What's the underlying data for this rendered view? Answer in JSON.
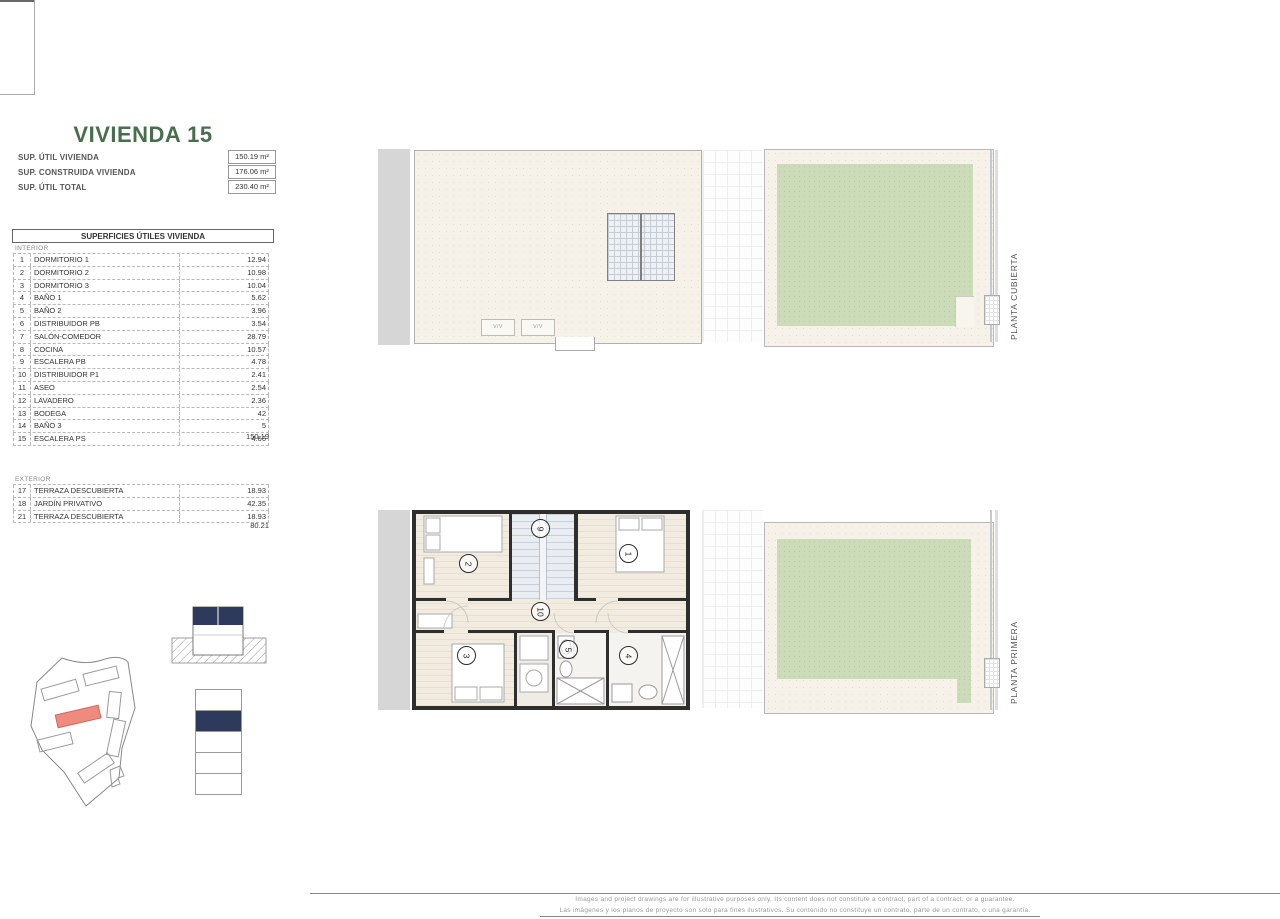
{
  "colors": {
    "accent_green": "#4a6e4d",
    "garden_green": "#cddcb8",
    "site_highlight": "#ee8b7e",
    "level_navy": "#2e3a5c",
    "wall_dark": "#2e2e2e"
  },
  "panel": {
    "title": "VIVIENDA 15",
    "summary": [
      {
        "label": "SUP. ÚTIL VIVIENDA",
        "value": "150.19 m²"
      },
      {
        "label": "SUP. CONSTRUIDA VIVIENDA",
        "value": "176.06 m²"
      },
      {
        "label": "SUP. ÚTIL TOTAL",
        "value": "230.40 m²"
      }
    ],
    "table_header": "SUPERFICIES ÚTILES VIVIENDA",
    "interior_label": "INTERIOR",
    "interior_rows": [
      {
        "n": "1",
        "name": "DORMITORIO 1",
        "value": "12.94"
      },
      {
        "n": "2",
        "name": "DORMITORIO 2",
        "value": "10.98"
      },
      {
        "n": "3",
        "name": "DORMITORIO 3",
        "value": "10.04"
      },
      {
        "n": "4",
        "name": "BAÑO 1",
        "value": "5.62"
      },
      {
        "n": "5",
        "name": "BAÑO 2",
        "value": "3.96"
      },
      {
        "n": "6",
        "name": "DISTRIBUIDOR PB",
        "value": "3.54"
      },
      {
        "n": "7",
        "name": "SALÓN-COMEDOR",
        "value": "28.79"
      },
      {
        "n": "8",
        "name": "COCINA",
        "value": "10.57"
      },
      {
        "n": "9",
        "name": "ESCALERA PB",
        "value": "4.78"
      },
      {
        "n": "10",
        "name": "DISTRIBUIDOR P1",
        "value": "2.41"
      },
      {
        "n": "11",
        "name": "ASEO",
        "value": "2.54"
      },
      {
        "n": "12",
        "name": "LAVADERO",
        "value": "2.36"
      },
      {
        "n": "13",
        "name": "BODEGA",
        "value": "42"
      },
      {
        "n": "14",
        "name": "BAÑO 3",
        "value": "5"
      },
      {
        "n": "15",
        "name": "ESCALERA PS",
        "value": "4.66"
      }
    ],
    "interior_total": "150.19",
    "exterior_label": "EXTERIOR",
    "exterior_rows": [
      {
        "n": "17",
        "name": "TERRAZA DESCUBIERTA",
        "value": "18.93"
      },
      {
        "n": "18",
        "name": "JARDÍN PRIVATIVO",
        "value": "42.35"
      },
      {
        "n": "21",
        "name": "TERRAZA DESCUBIERTA",
        "value": "18.93"
      }
    ],
    "exterior_total": "80.21"
  },
  "plans": {
    "top_label": "PLANTA CUBIERTA",
    "bottom_label": "PLANTA PRIMERA",
    "vent_marker_1": "V/V",
    "vent_marker_2": "V/V",
    "room_numbers": {
      "dorm1": "1",
      "dorm2": "2",
      "dorm3": "3",
      "bath1": "4",
      "bath2": "5",
      "stair": "9",
      "hall": "10"
    }
  },
  "disclaimer": {
    "line_en": "Images and project drawings are for illustrative purposes only. Its content does not constitute a contract, part of a contract, or a guarantee.",
    "line_es": "Las imágenes y los planos de proyecto son solo para fines ilustrativos. Su contenido no constituye un contrato, parte de un contrato, o una garantía."
  }
}
